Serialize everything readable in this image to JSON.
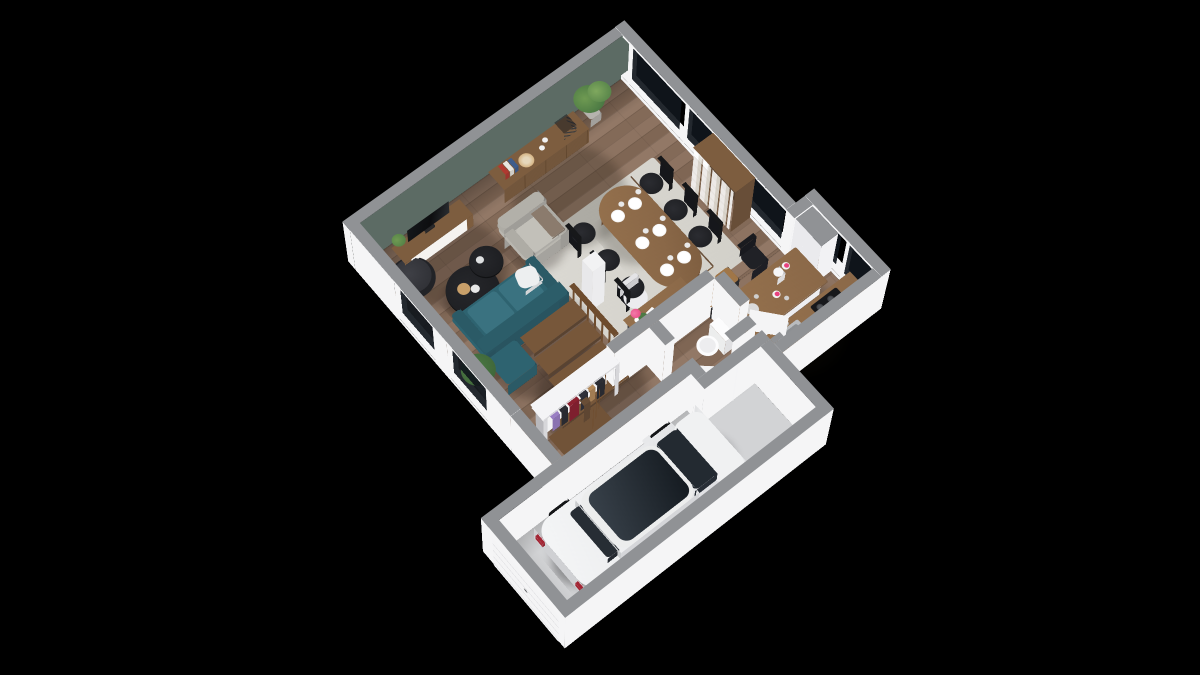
{
  "scene": {
    "type": "3d-floorplan-render",
    "view": "isometric-top-down",
    "background": "#000000"
  },
  "palette": {
    "cap": "#909295",
    "capLight": "#9b9da0",
    "wallWhite": "#f5f5f6",
    "wallShade": "#e7e7ea",
    "wallGreen": "#5c6b64",
    "floorWood": "#8d7361",
    "floorWoodDark": "#7f6654",
    "floorGarage": "#d2d3d5",
    "rug": "#dbd9d3",
    "sofaTeal": "#2e6370",
    "sofaCushion": "#3a7280",
    "pillowWhite": "#edeff0",
    "woodFurniture": "#7d5d3f",
    "woodTable": "#8a6848",
    "woodStairs": "#77573a",
    "railWood": "#6e4c2e",
    "blackFurniture": "#1b1c1f",
    "tvBlack": "#0d0e10",
    "armchairGrey": "#b9b7b0",
    "throwTaupe": "#8b7b6d",
    "plantGreen": "#4c7a44",
    "plantDark": "#3c6136",
    "carWhite": "#e8e9eb",
    "carGlass": "#232a31",
    "tailRed": "#a32433",
    "windowGlass": "rgba(16,22,28,0.92)",
    "steel": "#b9bcbf",
    "cooktopBlack": "#17181b",
    "accentPink": "#e8417e",
    "clothesPurple": "#9a7fc4",
    "clothesRed": "#8c2130",
    "clothesDark": "#2c2d33",
    "clothesTan": "#b48a5a",
    "brassRail": "#c8a45a",
    "doorWhite": "#f4f4f5",
    "toiletWhite": "#fcfcfd",
    "paperWhite": "#fafafa"
  },
  "rooms": [
    {
      "id": "living-room",
      "floor": "wood"
    },
    {
      "id": "dining-area",
      "floor": "wood-with-rug"
    },
    {
      "id": "kitchen",
      "floor": "wood"
    },
    {
      "id": "hallway-entry",
      "floor": "wood"
    },
    {
      "id": "wc",
      "floor": "wood"
    },
    {
      "id": "garage",
      "floor": "concrete"
    }
  ],
  "furniture": {
    "living": [
      "tv-bench",
      "tv",
      "round-lounge-chair",
      "sideboard",
      "decor-books",
      "decor-plate",
      "decor-basket",
      "armchair",
      "throw-blanket",
      "coffee-table-large",
      "coffee-table-small",
      "sofa",
      "white-pillow",
      "floor-plant",
      "corner-plant",
      "winder-staircase",
      "stair-railing"
    ],
    "dining": [
      "oval-dining-table",
      "dining-chairs-x6",
      "place-settings-x6",
      "area-rug",
      "support-column",
      "bookshelf"
    ],
    "kitchen": [
      "kitchen-island",
      "bar-stools",
      "pitcher",
      "pink-lid-jars",
      "counter",
      "sink",
      "cooktop",
      "tall-cabinet-fridge",
      "interior-door"
    ],
    "hallway": [
      "open-wardrobe-coat-rack",
      "hanging-clothes",
      "console-desk",
      "desk-chair",
      "pink-flowers",
      "interior-door"
    ],
    "wc": [
      "toilet"
    ],
    "garage": [
      "car",
      "garage-door"
    ]
  },
  "vehicle": {
    "type": "hatchback-car",
    "color": "white",
    "facing": "rear-toward-garage-door"
  }
}
